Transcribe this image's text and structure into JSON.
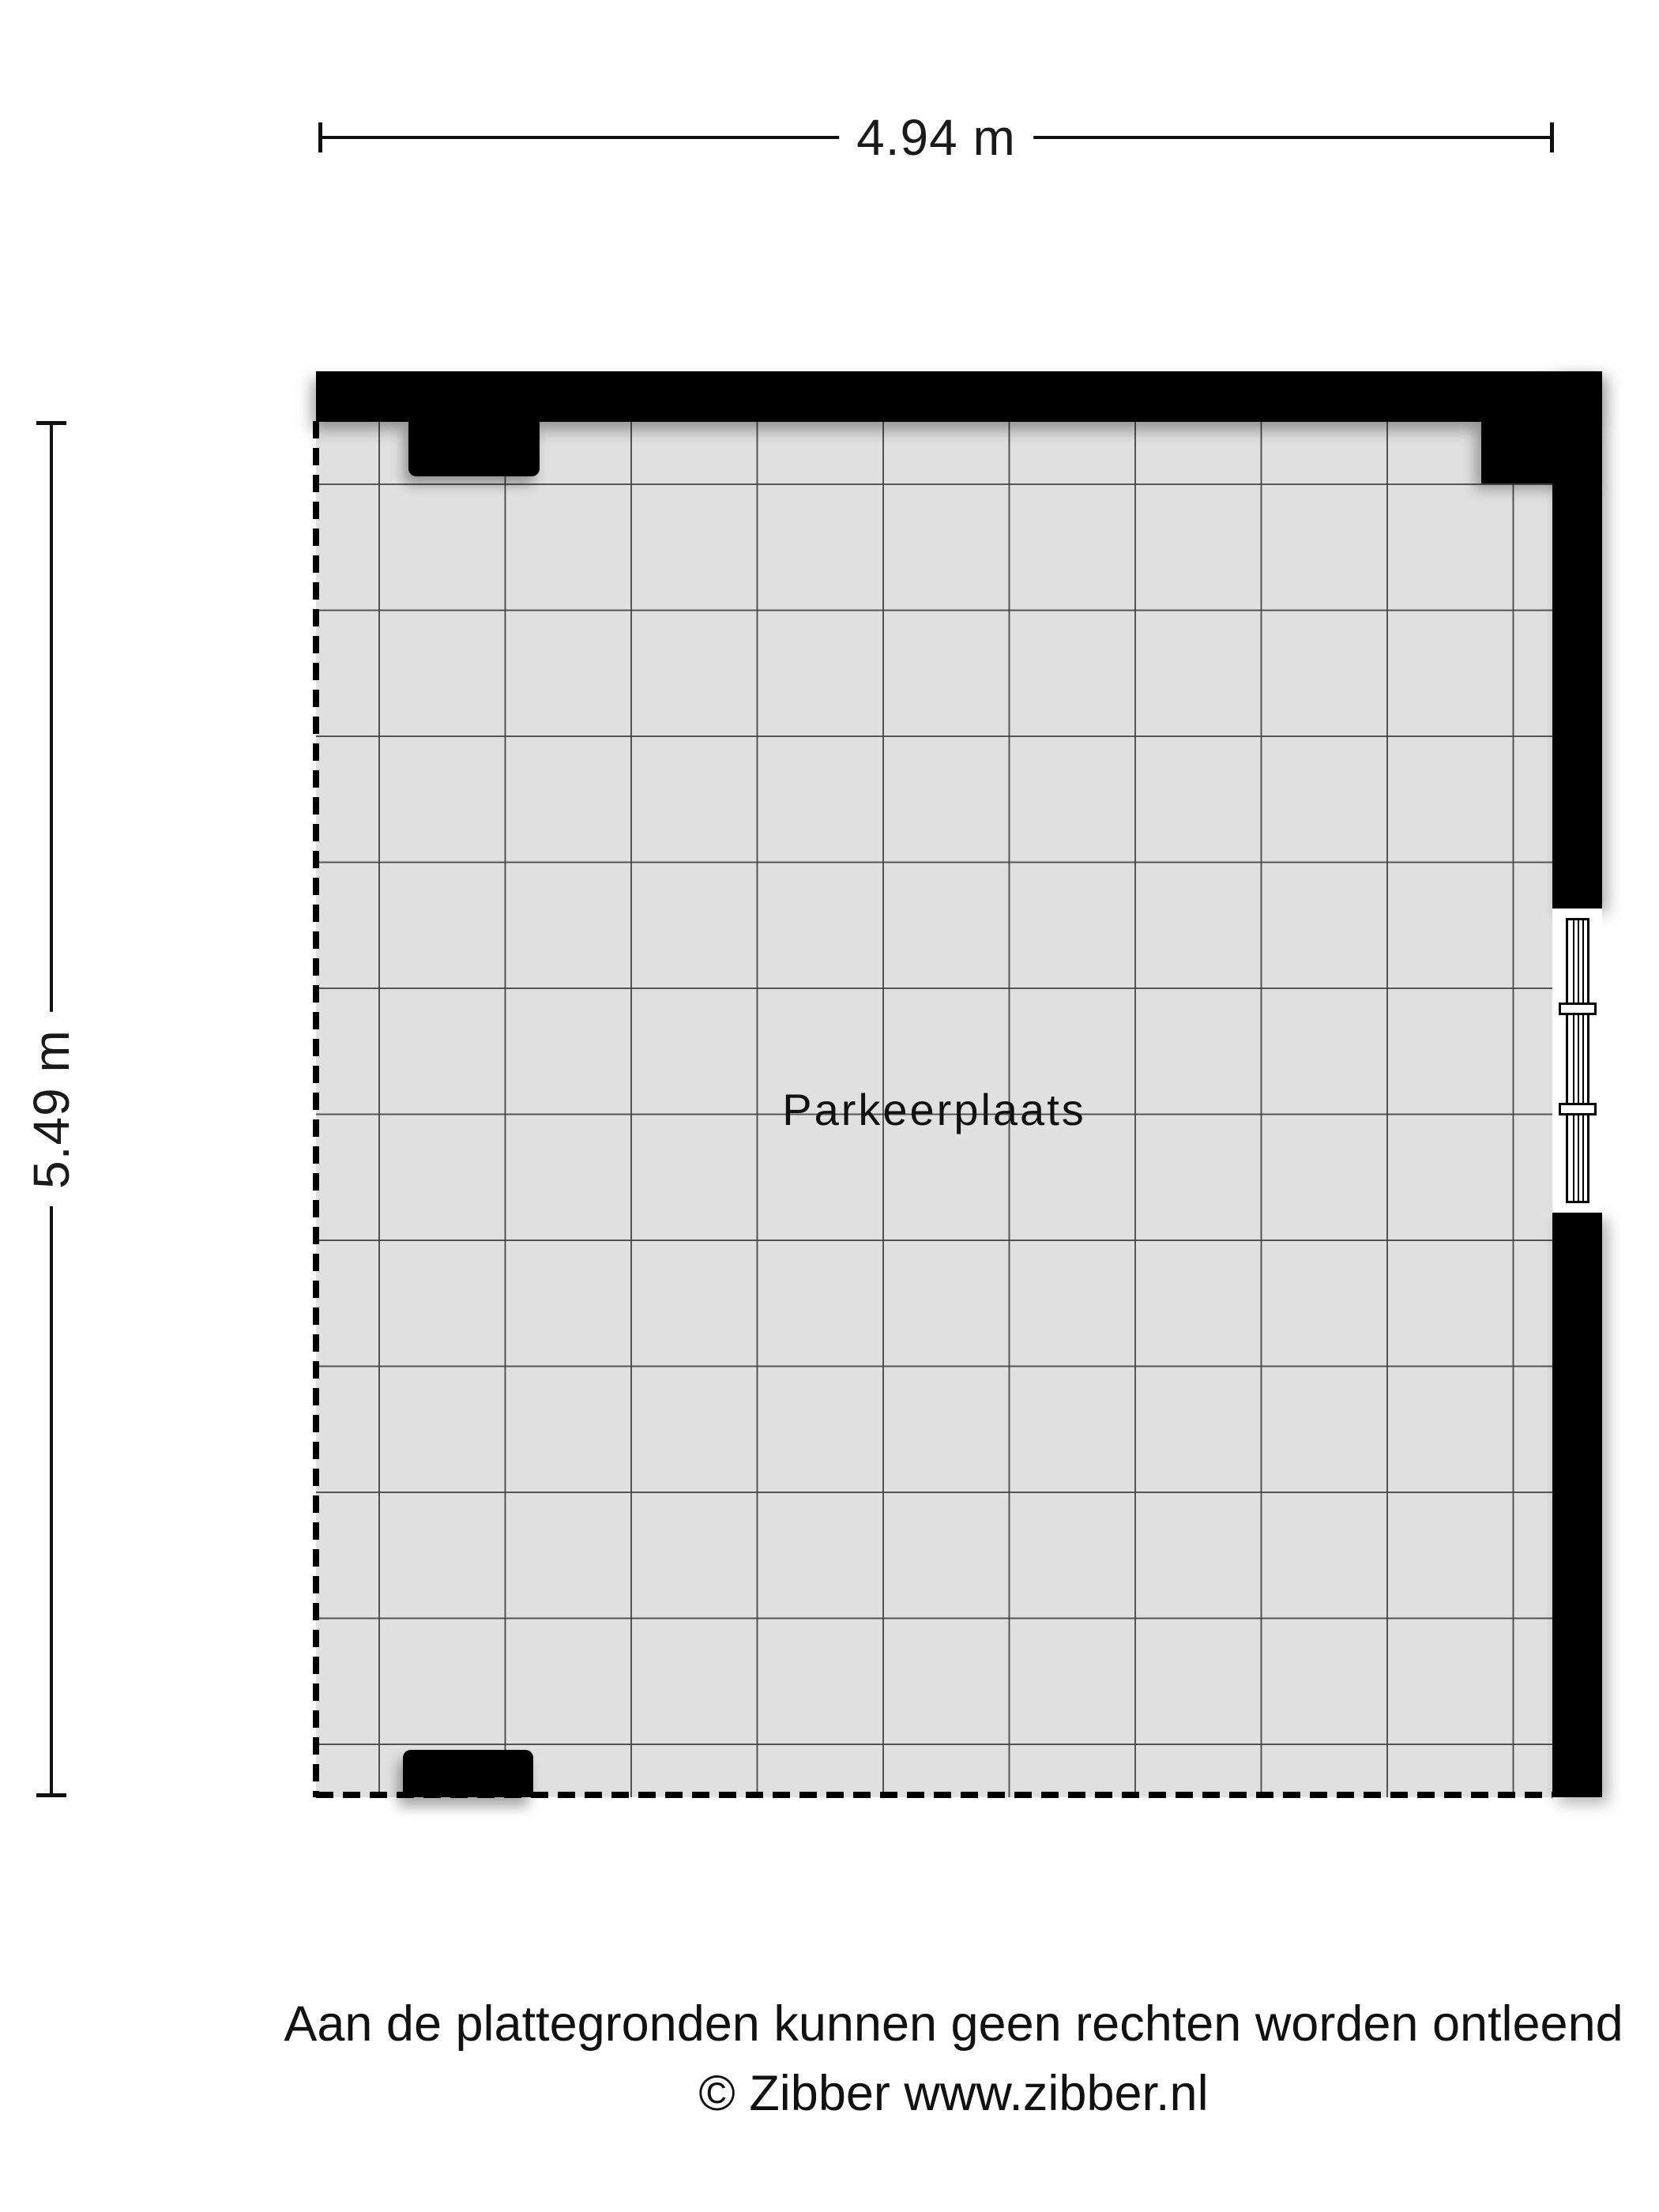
{
  "dimensions": {
    "width_label": "4.94 m",
    "height_label": "5.49 m"
  },
  "room": {
    "name": "Parkeerplaats"
  },
  "footer": {
    "disclaimer": "Aan de plattegronden kunnen geen rechten worden ontleend",
    "copyright": "© Zibber www.zibber.nl"
  },
  "colors": {
    "background": "#ffffff",
    "wall": "#000000",
    "floor": "#e0e0e0",
    "grid_line": "#3c3c3c",
    "text": "#111111"
  }
}
